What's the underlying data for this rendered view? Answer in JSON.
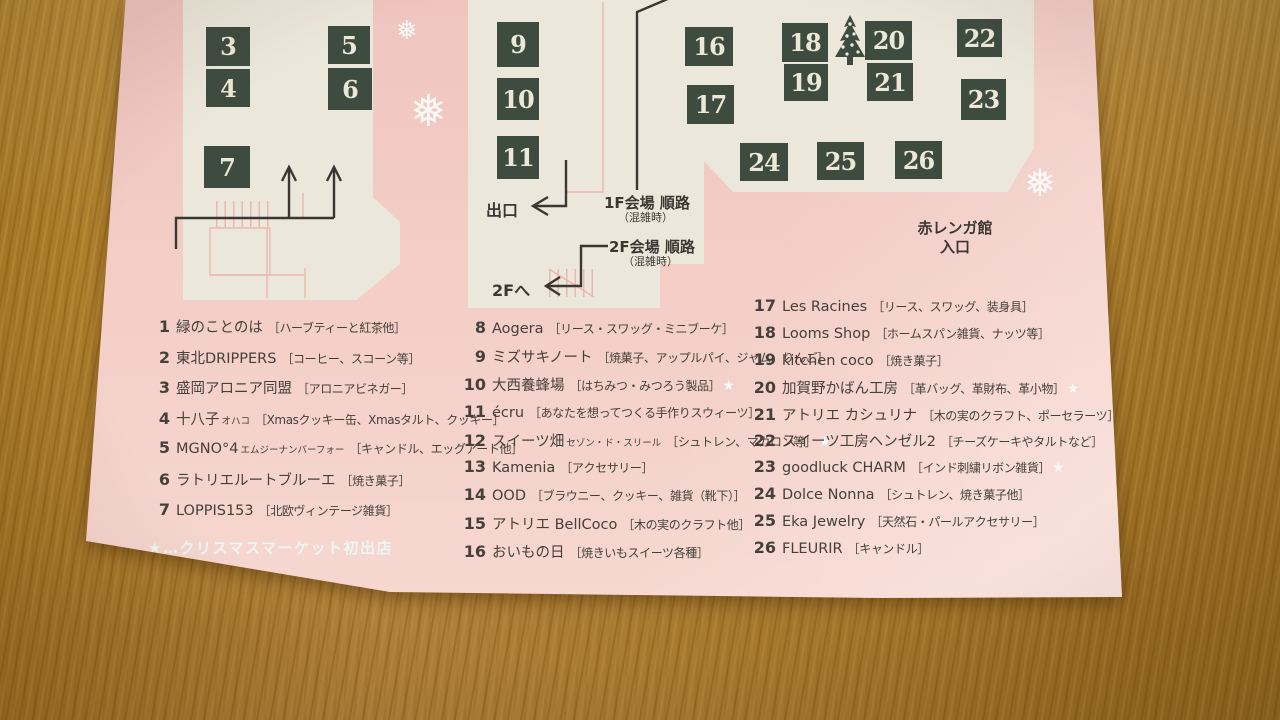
{
  "colors": {
    "paper_pink": "#f3cbc5",
    "floor_cream": "#ebe7da",
    "booth_green": "#3e4c40",
    "route_ink": "#3a3733",
    "pink_line": "#ecb7ae",
    "snow_white": "#f2faf6",
    "wood_brown": "#b28434"
  },
  "map": {
    "booths": [
      {
        "num": "3",
        "x": 206,
        "y": 27,
        "w": 44,
        "h": 39
      },
      {
        "num": "4",
        "x": 206,
        "y": 69,
        "w": 44,
        "h": 38
      },
      {
        "num": "5",
        "x": 328,
        "y": 26,
        "w": 42,
        "h": 38
      },
      {
        "num": "6",
        "x": 328,
        "y": 68,
        "w": 44,
        "h": 42
      },
      {
        "num": "7",
        "x": 204,
        "y": 146,
        "w": 46,
        "h": 42
      },
      {
        "num": "9",
        "x": 497,
        "y": 22,
        "w": 42,
        "h": 45
      },
      {
        "num": "10",
        "x": 497,
        "y": 78,
        "w": 42,
        "h": 42
      },
      {
        "num": "11",
        "x": 497,
        "y": 136,
        "w": 42,
        "h": 43
      },
      {
        "num": "16",
        "x": 685,
        "y": 27,
        "w": 48,
        "h": 39
      },
      {
        "num": "17",
        "x": 687,
        "y": 85,
        "w": 47,
        "h": 39
      },
      {
        "num": "18",
        "x": 782,
        "y": 23,
        "w": 46,
        "h": 39
      },
      {
        "num": "19",
        "x": 784,
        "y": 64,
        "w": 44,
        "h": 37
      },
      {
        "num": "20",
        "x": 865,
        "y": 21,
        "w": 47,
        "h": 39
      },
      {
        "num": "21",
        "x": 867,
        "y": 63,
        "w": 46,
        "h": 38
      },
      {
        "num": "22",
        "x": 957,
        "y": 19,
        "w": 45,
        "h": 38
      },
      {
        "num": "23",
        "x": 961,
        "y": 79,
        "w": 45,
        "h": 41
      },
      {
        "num": "24",
        "x": 740,
        "y": 143,
        "w": 48,
        "h": 38
      },
      {
        "num": "25",
        "x": 817,
        "y": 142,
        "w": 47,
        "h": 38
      },
      {
        "num": "26",
        "x": 895,
        "y": 141,
        "w": 47,
        "h": 38
      }
    ],
    "labels": {
      "exit": "出口",
      "route_1f": "1F会場 順路",
      "route_1f_note": "（混雑時）",
      "route_2f": "2F会場 順路",
      "route_2f_note": "（混雑時）",
      "to_2f": "2Fへ",
      "entrance_line1": "赤レンガ館",
      "entrance_line2": "入口"
    },
    "tree_icon": "christmas-tree-icon",
    "snowflake_glyph": "❅",
    "snowflakes": [
      {
        "x": 396,
        "y": 18,
        "size": 26
      },
      {
        "x": 410,
        "y": 90,
        "size": 44
      },
      {
        "x": 1024,
        "y": 164,
        "size": 38
      }
    ]
  },
  "legend": {
    "star_glyph": "★",
    "note": "★…クリスマスマーケット初出店",
    "columns": [
      {
        "x": 146,
        "y": 316,
        "row_h": 30.6,
        "items": [
          {
            "num": "1",
            "name": "緑のことのは",
            "sub": "",
            "desc": "［ハーブティーと紅茶他］",
            "star": false
          },
          {
            "num": "2",
            "name": "東北DRIPPERS",
            "sub": "",
            "desc": "［コーヒー、スコーン等］",
            "star": false
          },
          {
            "num": "3",
            "name": "盛岡アロニア同盟",
            "sub": "",
            "desc": "［アロニアビネガー］",
            "star": false
          },
          {
            "num": "4",
            "name": "十八子",
            "sub": "オハコ",
            "desc": "［Xmasクッキー缶、Xmasタルト、クッキー］",
            "star": false
          },
          {
            "num": "5",
            "name": "MGNO°4",
            "sub": "エムジーナンバーフォー",
            "desc": "［キャンドル、エッグアート他］",
            "star": false
          },
          {
            "num": "6",
            "name": "ラトリエルートブルーエ",
            "sub": "",
            "desc": "［焼き菓子］",
            "star": false
          },
          {
            "num": "7",
            "name": "LOPPIS153",
            "sub": "",
            "desc": "［北欧ヴィンテージ雑貨］",
            "star": false
          }
        ]
      },
      {
        "x": 462,
        "y": 318,
        "row_h": 27.9,
        "items": [
          {
            "num": "8",
            "name": "Aogera",
            "sub": "",
            "desc": "［リース・スワッグ・ミニブーケ］",
            "star": false
          },
          {
            "num": "9",
            "name": "ミズサキノート",
            "sub": "",
            "desc": "［焼菓子、アップルパイ、ジャム、りんご］",
            "star": false
          },
          {
            "num": "10",
            "name": "大西養蜂場",
            "sub": "",
            "desc": "［はちみつ・みつろう製品］",
            "star": true
          },
          {
            "num": "11",
            "name": "écru",
            "sub": "",
            "desc": "［あなたを想ってつくる手作りスウィーツ］",
            "star": false
          },
          {
            "num": "12",
            "name": "スイーツ畑",
            "sub": "セゾン・ド・スリール",
            "desc": "［シュトレン、マカロン等］",
            "star": true
          },
          {
            "num": "13",
            "name": "Kamenia",
            "sub": "",
            "desc": "［アクセサリー］",
            "star": false
          },
          {
            "num": "14",
            "name": "OOD",
            "sub": "",
            "desc": "［ブラウニー、クッキー、雑貨（靴下）］",
            "star": false
          },
          {
            "num": "15",
            "name": "アトリエ BellCoco",
            "sub": "",
            "desc": "［木の実のクラフト他］",
            "star": false
          },
          {
            "num": "16",
            "name": "おいもの日",
            "sub": "",
            "desc": "［焼きいもスイーツ各種］",
            "star": false
          }
        ]
      },
      {
        "x": 752,
        "y": 296,
        "row_h": 26.9,
        "items": [
          {
            "num": "17",
            "name": "Les Racines",
            "sub": "",
            "desc": "［リース、スワッグ、装身具］",
            "star": false
          },
          {
            "num": "18",
            "name": "Looms Shop",
            "sub": "",
            "desc": "［ホームスパン雑貨、ナッツ等］",
            "star": false
          },
          {
            "num": "19",
            "name": "kitchen coco",
            "sub": "",
            "desc": "［焼き菓子］",
            "star": false
          },
          {
            "num": "20",
            "name": "加賀野かばん工房",
            "sub": "",
            "desc": "［革バッグ、革財布、革小物］",
            "star": true
          },
          {
            "num": "21",
            "name": "アトリエ カシュリナ",
            "sub": "",
            "desc": "［木の実のクラフト、ポーセラーツ］",
            "star": false
          },
          {
            "num": "22",
            "name": "スイーツ工房ヘンゼル2",
            "sub": "",
            "desc": "［チーズケーキやタルトなど］",
            "star": false
          },
          {
            "num": "23",
            "name": "goodluck CHARM",
            "sub": "",
            "desc": "［インド刺繍リボン雑貨］",
            "star": true
          },
          {
            "num": "24",
            "name": "Dolce Nonna",
            "sub": "",
            "desc": "［シュトレン、焼き菓子他］",
            "star": false
          },
          {
            "num": "25",
            "name": "Eka Jewelry",
            "sub": "",
            "desc": "［天然石・パールアクセサリー］",
            "star": false
          },
          {
            "num": "26",
            "name": "FLEURIR",
            "sub": "",
            "desc": "［キャンドル］",
            "star": false
          }
        ]
      }
    ]
  }
}
